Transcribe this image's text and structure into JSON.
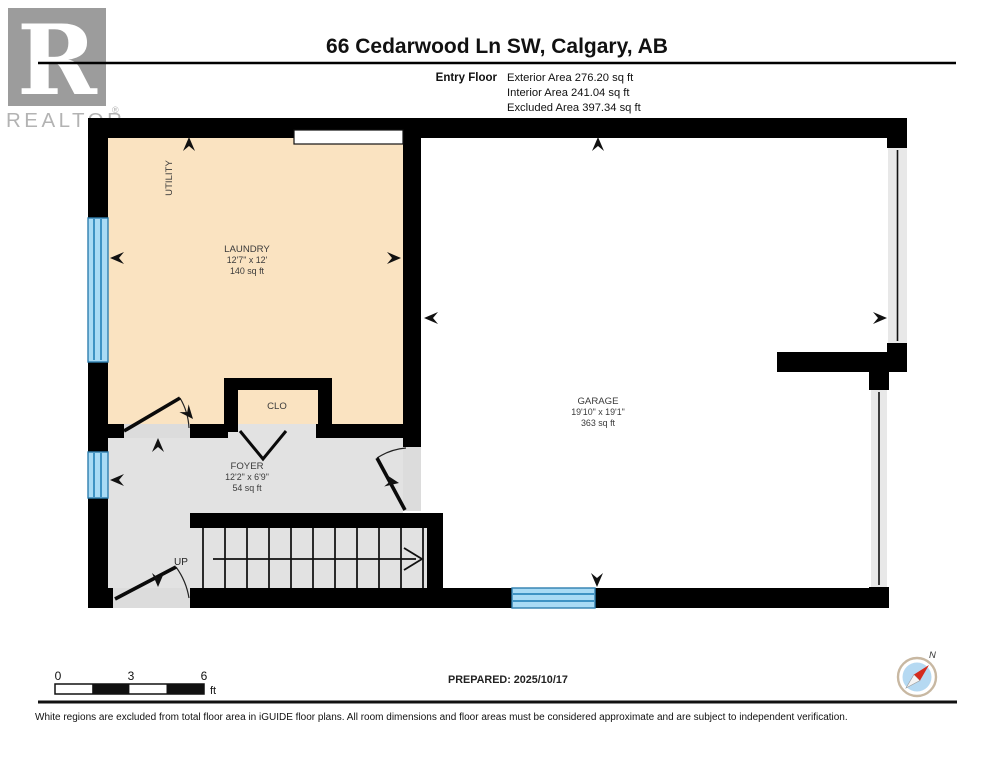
{
  "header": {
    "logo": {
      "letter": "R",
      "brand": "REALTOR",
      "registered": "®"
    },
    "title": "66 Cedarwood Ln SW, Calgary, AB",
    "floor_label": "Entry Floor",
    "areas": [
      {
        "label": "Exterior Area 276.20 sq ft"
      },
      {
        "label": "Interior Area 241.04 sq ft"
      },
      {
        "label": "Excluded Area 397.34 sq ft"
      }
    ]
  },
  "floorplan": {
    "rooms": [
      {
        "name": "UTILITY"
      },
      {
        "name": "LAUNDRY",
        "dims": "12'7\" x 12'",
        "area": "140 sq ft"
      },
      {
        "name": "CLO"
      },
      {
        "name": "FOYER",
        "dims": "12'2\" x 6'9\"",
        "area": "54 sq ft"
      },
      {
        "name": "GARAGE",
        "dims": "19'10\" x 19'1\"",
        "area": "363 sq ft"
      }
    ],
    "stairs_label": "UP",
    "colors": {
      "included_room": "#FAE3C1",
      "foyer_room": "#E2E2E2",
      "excluded_room": "#FFFFFF",
      "window_fill": "#A9DBF5",
      "window_line": "#2F7FAF",
      "wall": "#000000"
    }
  },
  "footer": {
    "scale": {
      "ticks": [
        "0",
        "3",
        "6"
      ],
      "unit": "ft"
    },
    "prepared": "PREPARED: 2025/10/17",
    "compass_label": "N",
    "disclaimer": "White regions are excluded from total floor area in iGUIDE floor plans. All room dimensions and floor areas must be considered approximate and are subject to independent verification."
  }
}
